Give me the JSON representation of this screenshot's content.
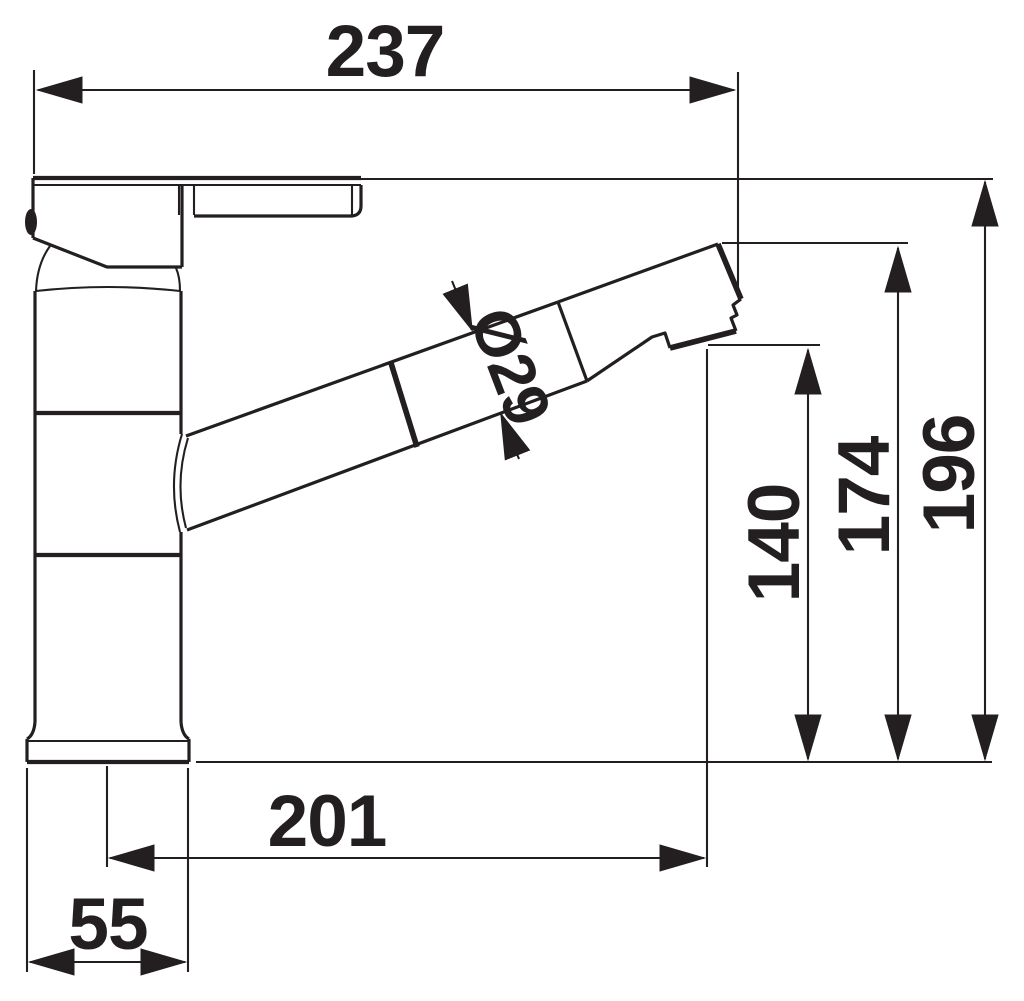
{
  "drawing": {
    "type": "technical dimension drawing",
    "subject": "single-lever kitchen mixer tap with pull-out spray head, side view",
    "line_color": "#231f20",
    "background_color": "#ffffff"
  },
  "dimensions": {
    "overall_width": "237",
    "overall_height": "196",
    "spout_tip_height": "174",
    "outlet_height": "140",
    "outlet_reach": "201",
    "base_width": "55",
    "spout_diameter": "Ø29"
  }
}
